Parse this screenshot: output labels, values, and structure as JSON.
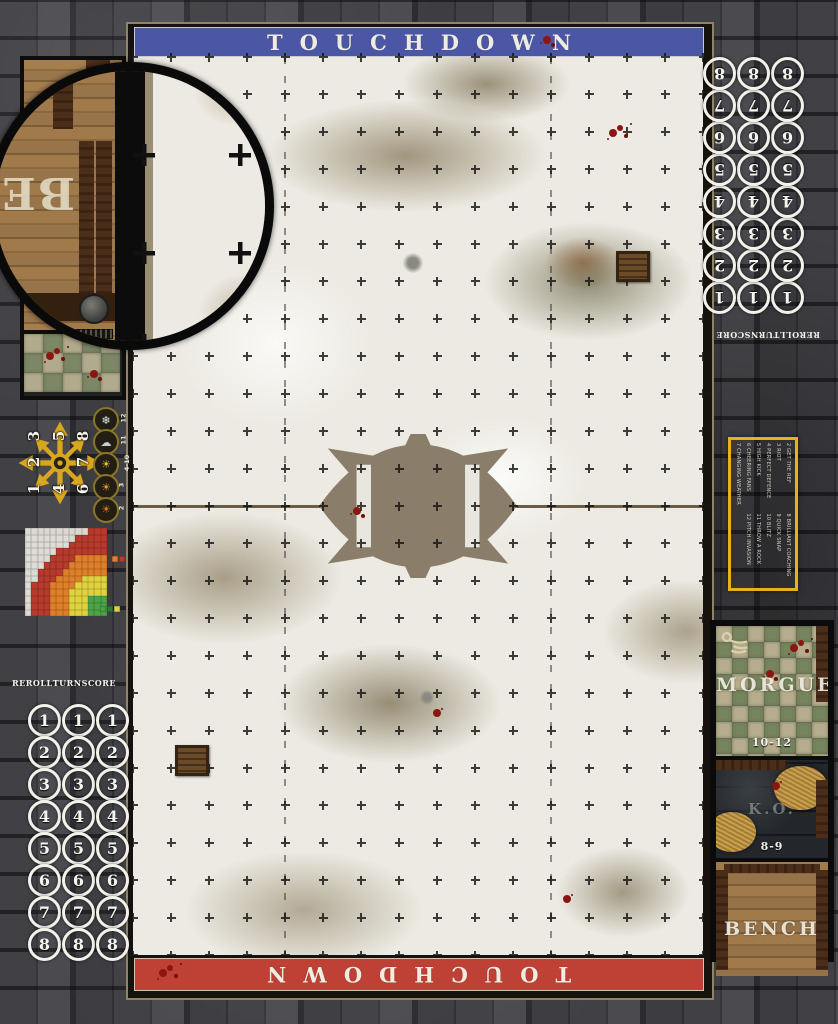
{
  "mat_title": "Blood Bowl winter pitch game mat",
  "colors": {
    "banner_top": "#4b57a5",
    "banner_bottom": "#bf4034",
    "pitch_snow": "#eceae2",
    "frame_line": "#8f8467",
    "accent_gold": "#e7b11c",
    "track_circle": "#f2f1ea"
  },
  "banner_top": {
    "label": "TOUCHDOWN"
  },
  "banner_bottom": {
    "label": "TOUCHDOWN"
  },
  "turn_track": {
    "headers": [
      "REROLL",
      "TURN",
      "SCORE"
    ],
    "rows": [
      "1",
      "2",
      "3",
      "4",
      "5",
      "6",
      "7",
      "8"
    ]
  },
  "scatter_template": {
    "layout": [
      [
        "3",
        "5",
        "8"
      ],
      [
        "2",
        "",
        "7"
      ],
      [
        "1",
        "4",
        "6"
      ]
    ]
  },
  "weather_table": {
    "rows": [
      {
        "label": "12",
        "glyph": "❄",
        "name": "blizzard-icon",
        "color": "#dce8f0"
      },
      {
        "label": "11",
        "glyph": "☁",
        "name": "pouring-rain-icon",
        "color": "#c9cdd2"
      },
      {
        "label": "4-10",
        "glyph": "☀",
        "name": "perfect-weather-icon",
        "color": "#e8c23a"
      },
      {
        "label": "3",
        "glyph": "☀",
        "name": "very-sunny-icon",
        "color": "#e8a11f"
      },
      {
        "label": "2",
        "glyph": "☀",
        "name": "sweltering-heat-icon",
        "color": "#e07818"
      }
    ]
  },
  "range_ruler": {
    "cell_colors": {
      "W": "#efece4",
      "R": "#b83a2c",
      "O": "#df7f2a",
      "Y": "#e0d23c",
      "G": "#4da347"
    },
    "rows": [
      "WWWWWWWWWWRRR",
      "WWWWWWWWRRRRR",
      "WWWWWWWRRRRRR",
      "WWWWWRRRRRRRR",
      "WWWWRRRROOOOO",
      "WWWRRRROOOOOO",
      "WWRRRROOOOOOO",
      "WWRRROOOOYYYY",
      "WRRROOOOYYYYY",
      "WRRROOOYYYYYY",
      "WRRROOOYYYGGG",
      "WRRROOOYYYGGG",
      "WRRROOOYYYGGG"
    ],
    "legend_mid": [
      "#df7f2a",
      "#b83a2c"
    ],
    "legend_bottom": [
      "#4da347",
      "#2e7d32",
      "#e0d23c"
    ]
  },
  "kickoff_table": {
    "entries": [
      {
        "roll": "2",
        "label": "GET THE REF"
      },
      {
        "roll": "3",
        "label": "RIOT"
      },
      {
        "roll": "4",
        "label": "PERFECT DEFENCE"
      },
      {
        "roll": "5",
        "label": "HIGH KICK"
      },
      {
        "roll": "6",
        "label": "CHEERING FANS"
      },
      {
        "roll": "7",
        "label": "CHANGING WEATHER"
      },
      {
        "roll": "8",
        "label": "BRILLIANT COACHING"
      },
      {
        "roll": "9",
        "label": "QUICK SNAP"
      },
      {
        "roll": "10",
        "label": "BLITZ"
      },
      {
        "roll": "11",
        "label": "THROW A ROCK"
      },
      {
        "roll": "12",
        "label": "PITCH INVASION"
      }
    ]
  },
  "dugout": {
    "morgue": {
      "label": "MORGUE",
      "range": "10-12"
    },
    "ko": {
      "label": "K.O.",
      "range": "8-9"
    },
    "bench": {
      "label": "BENCH"
    }
  },
  "magnifier": {
    "visible_letters": "BE"
  }
}
